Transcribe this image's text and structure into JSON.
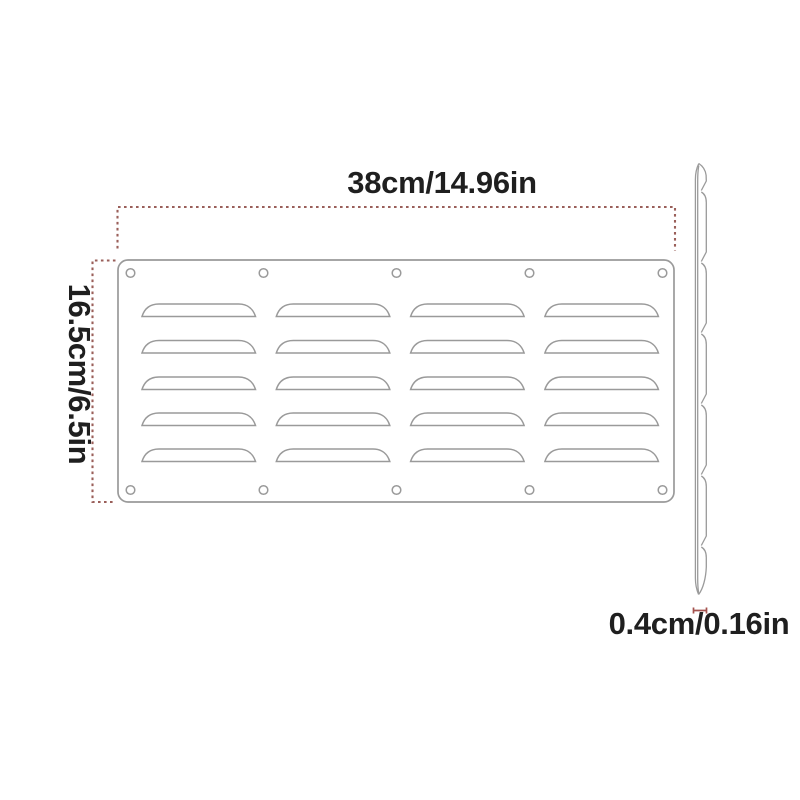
{
  "colors": {
    "text": "#1f1f1f",
    "drawing_line": "#9a9a9a",
    "dimension_line": "#9a5f5a",
    "thickness_marker": "#a4524e",
    "background": "#ffffff"
  },
  "diagram": {
    "title": "louvered vent plate dimension drawing",
    "width_label": "38cm/14.96in",
    "height_label": "16.5cm/6.5in",
    "thickness_label": "0.4cm/0.16in",
    "front_view": {
      "louver_columns": 4,
      "louver_rows": 5,
      "screw_hole_columns": 5,
      "screw_hole_rows": 2
    },
    "side_view": {
      "shingle_segments": 7
    }
  }
}
